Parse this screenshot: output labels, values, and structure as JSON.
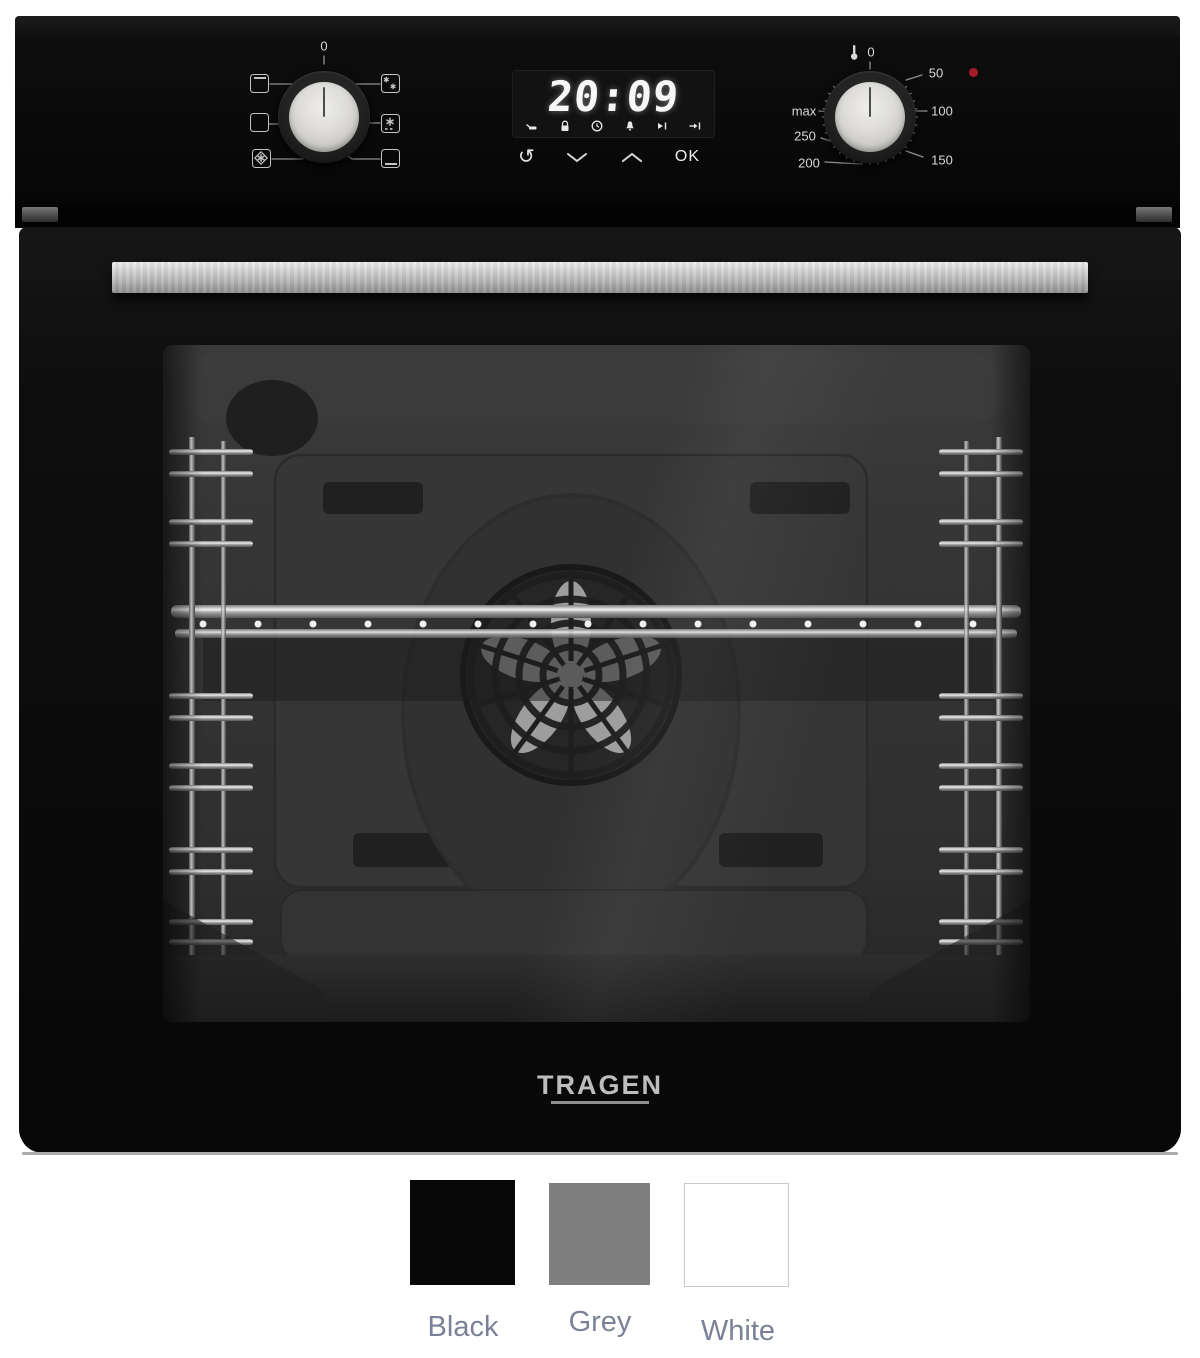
{
  "logo": "TRAGEN",
  "panel": {
    "function_dial": {
      "zero": "0"
    },
    "display": {
      "time": "20:09",
      "ok": "OK",
      "cycle_glyph": "↻"
    },
    "temperature_dial": {
      "zero": "0",
      "t50": "50",
      "t100": "100",
      "t150": "150",
      "t200": "200",
      "t250": "250",
      "max": "max"
    }
  },
  "icons": {
    "function_dial": [
      "grill-icon",
      "conventional-icon",
      "fan-grill-icon",
      "fan-defrost-icon",
      "defrost-icon",
      "bottom-heat-icon"
    ],
    "display_status": [
      "pan-icon",
      "lock-icon",
      "clock-icon",
      "bell-icon",
      "end-time-icon",
      "start-time-icon"
    ],
    "display_buttons": [
      "cycle-icon",
      "chevron-down-icon",
      "chevron-up-icon"
    ],
    "temperature_dial": [
      "thermometer-icon",
      "power-indicator-light"
    ]
  },
  "colors": {
    "indicator_red": "#a51c28",
    "swatch_label_text": "#7b8298"
  },
  "swatches": [
    {
      "name": "Black",
      "hex": "#070707"
    },
    {
      "name": "Grey",
      "hex": "#7f7f7f"
    },
    {
      "name": "White",
      "hex": "#ffffff"
    }
  ]
}
